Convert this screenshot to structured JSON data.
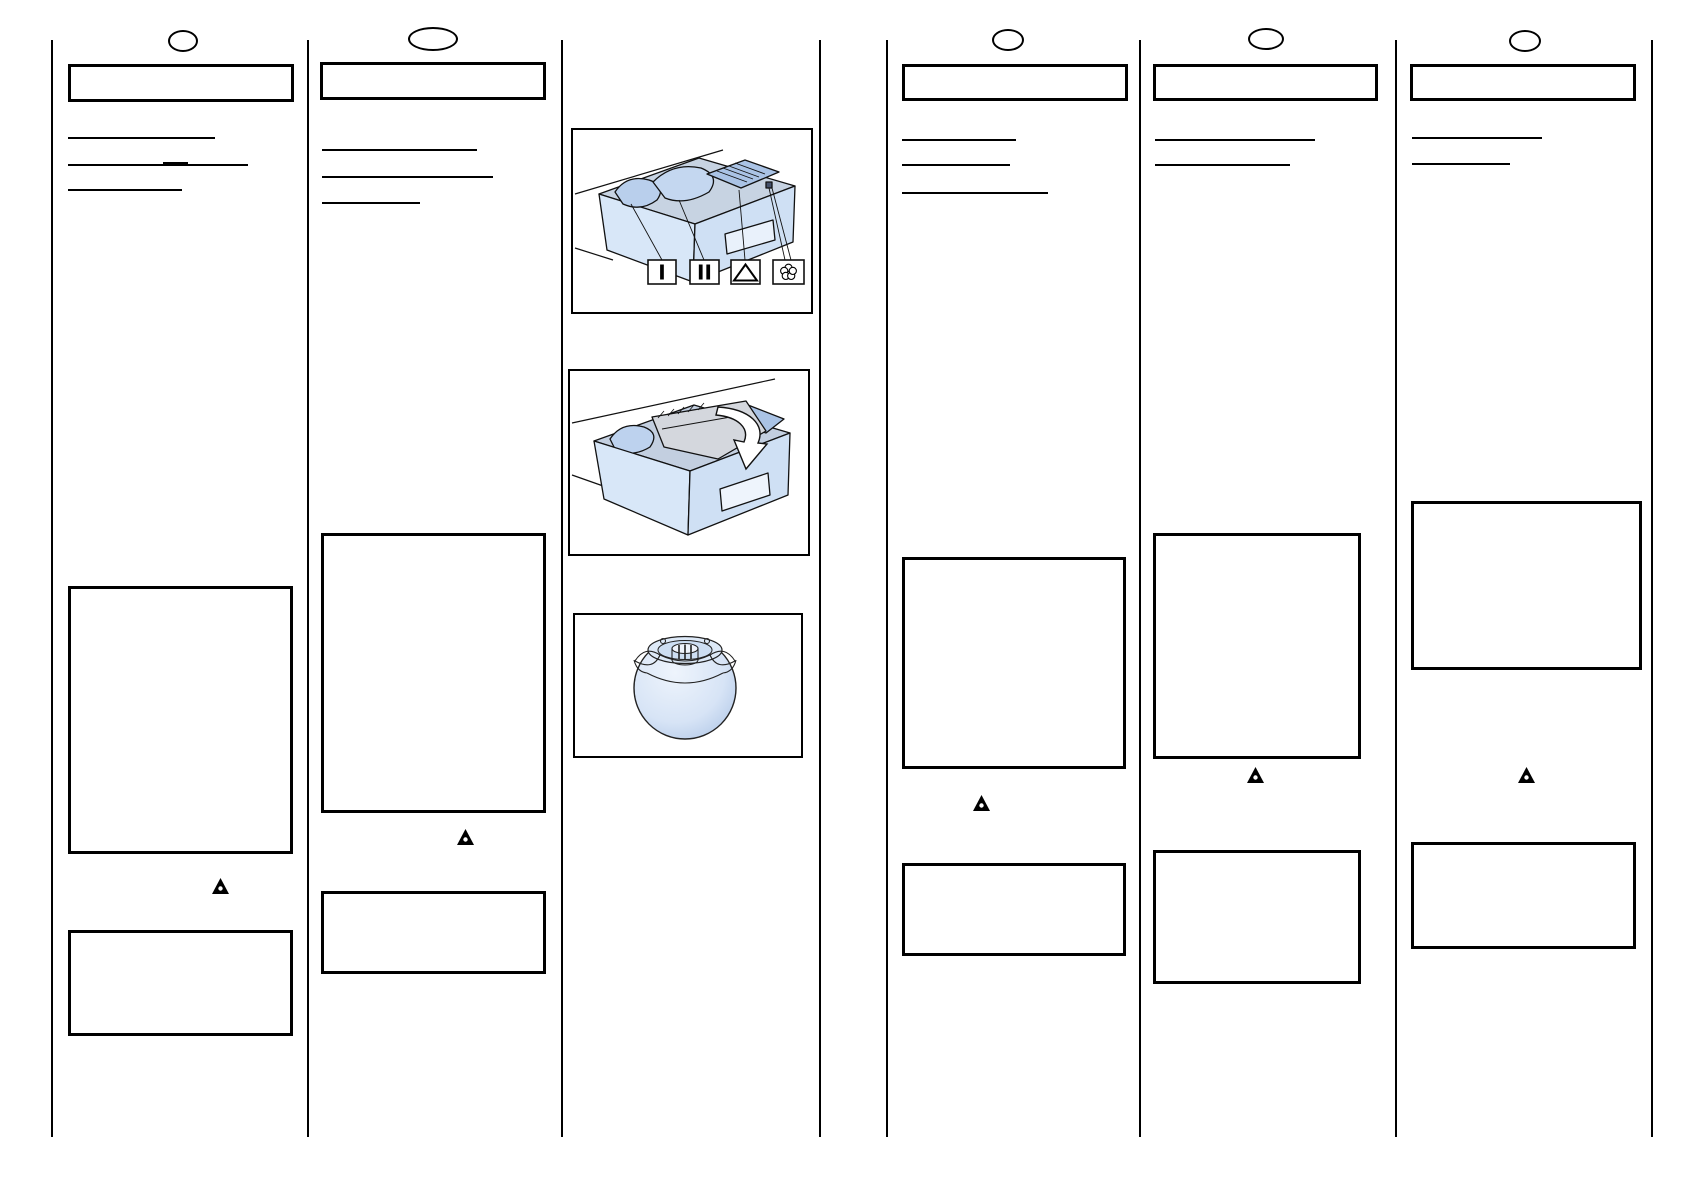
{
  "page": {
    "background": "#ffffff",
    "ink": "#000000",
    "description": "Blank instruction-manual spread template: six ruled columns with empty title boxes, heading underlines, empty content boxes, warning triangles, and washing-machine detergent-drawer illustrations"
  },
  "columns": [
    {
      "title": "",
      "page_marker": "oval",
      "heading_underlines": 3,
      "warning_icon": "⚠",
      "content_boxes": 2
    },
    {
      "title": "",
      "page_marker": "oval",
      "heading_underlines": 3,
      "warning_icon": "⚠",
      "content_boxes": 2
    },
    {
      "title": "",
      "page_marker": "oval",
      "heading_underlines": 3,
      "warning_icon": "⚠",
      "content_boxes": 2
    },
    {
      "title": "",
      "page_marker": "oval",
      "heading_underlines": 2,
      "warning_icon": "⚠",
      "content_boxes": 2
    },
    {
      "title": "",
      "page_marker": "oval",
      "heading_underlines": 2,
      "warning_icon": "⚠",
      "content_boxes": 2
    }
  ],
  "figures": {
    "detergent_drawer_open": {
      "symbols": [
        "I",
        "II",
        "△",
        "❀"
      ]
    },
    "detergent_drawer_scoop": {
      "arrow": "insert-direction-arrow"
    },
    "dosing_ball": {}
  },
  "colors": {
    "illustration_blue": "#cfe0f4",
    "illustration_blue_light": "#e9f1fb",
    "illustration_blue_dark": "#aac3e5",
    "illustration_grey": "#c7d3e2",
    "scoop_grey": "#d4d7dd",
    "outline": "#111111"
  }
}
